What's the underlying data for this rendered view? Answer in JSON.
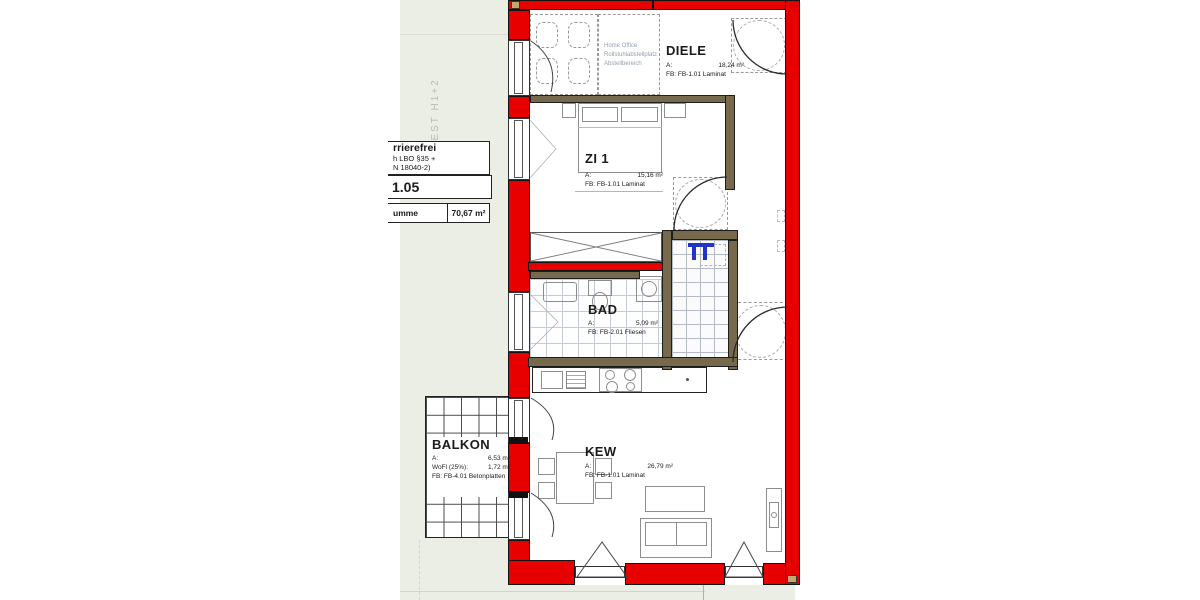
{
  "title_block": {
    "line1": "rrierefrei",
    "line2": "h LBO §35 +",
    "line3": "N 18040-2)",
    "unit_number": "1.05",
    "sum_label": "umme",
    "sum_value": "70,67 m²"
  },
  "compass_label": "WEST  H1+2",
  "rooms": {
    "diele": {
      "name": "DIELE",
      "area_label": "A:",
      "area_value": "18,24 m²",
      "floor_line": "FB: FB-1.01 Laminat"
    },
    "zi1": {
      "name": "ZI 1",
      "area_label": "A:",
      "area_value": "15,16 m²",
      "floor_line": "FB: FB-1.01 Laminat"
    },
    "bad": {
      "name": "BAD",
      "area_label": "A:",
      "area_value": "5,09 m²",
      "floor_line": "FB: FB-2.01 Fliesen"
    },
    "kew": {
      "name": "KEW",
      "area_label": "A:",
      "area_value": "26,79 m²",
      "floor_line": "FB: FB-1.01 Laminat"
    },
    "balkon": {
      "name": "BALKON",
      "area_label": "A:",
      "area_value": "6,53 m²",
      "wofl_label": "WoFl (25%):",
      "wofl_value": "1,72 m²",
      "floor_line": "FB: FB-4.01 Betonplatten"
    }
  },
  "notes": {
    "home_office": [
      "Home Office",
      "Rollstuhlabstellplatz",
      "Abstellbereich"
    ]
  },
  "colors": {
    "wall_red": "#e60000",
    "interior_wall": "#77694c",
    "fixture_blue": "#2233cc",
    "exterior_green": "#ebeee5"
  }
}
